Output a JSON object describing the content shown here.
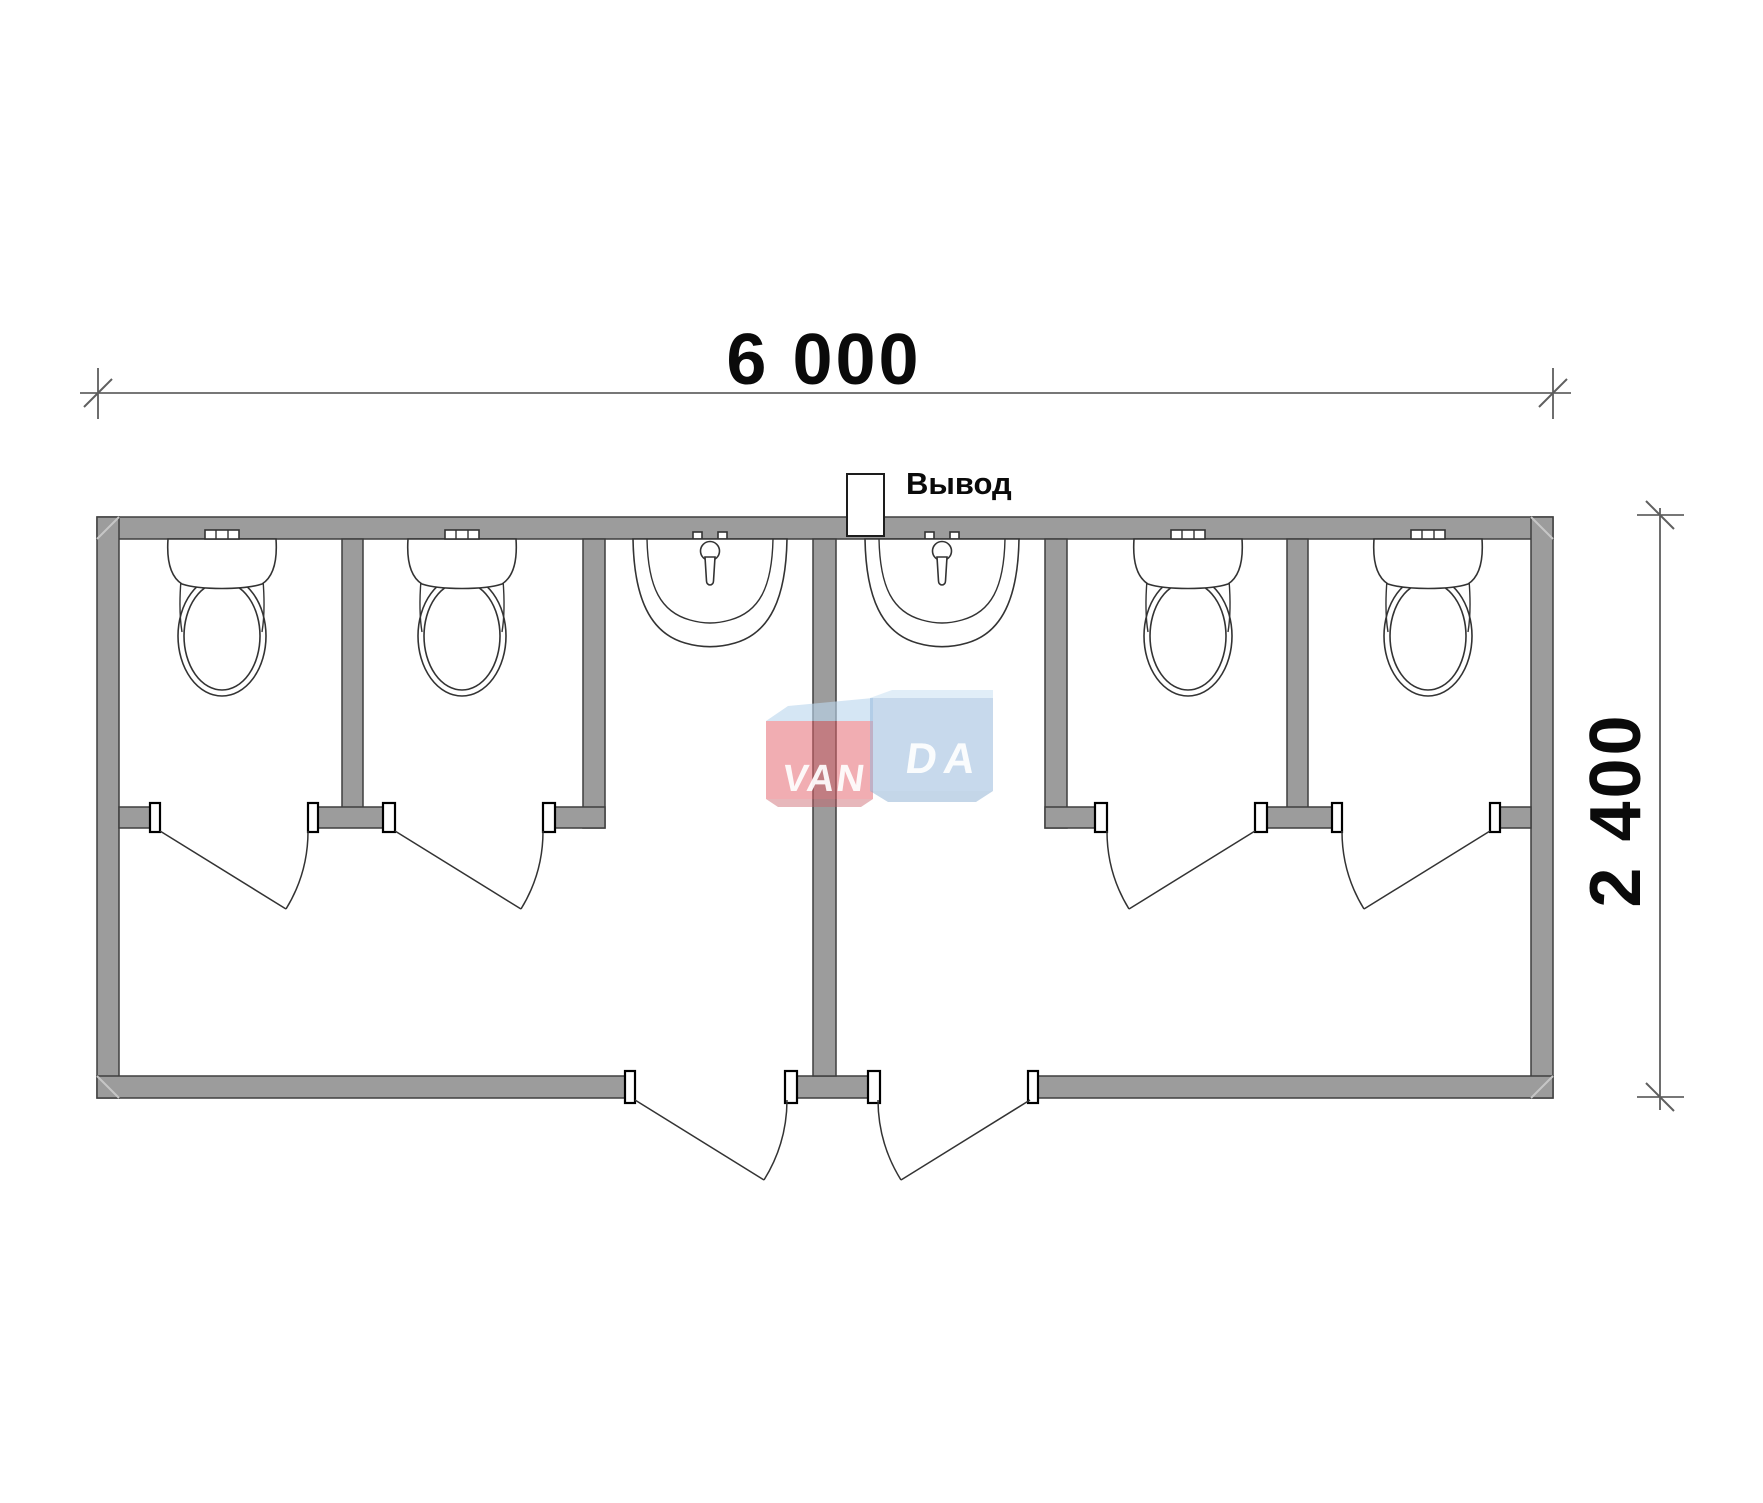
{
  "dimensions": {
    "width_label": "6 000",
    "height_label": "2 400"
  },
  "outlet": {
    "label": "Вывод"
  },
  "watermark": {
    "text": "VANDA",
    "left_text": "VAN",
    "right_text": "DA",
    "red_box_color": "#e4626b",
    "blue_box_color": "#8fb4da"
  },
  "colors": {
    "wall_fill": "#9c9c9c",
    "line": "#333333",
    "background": "#ffffff"
  },
  "plan_summary": {
    "toilet_stalls": 4,
    "sinks": 2,
    "entry_doors": 2,
    "stall_doors": 4
  }
}
